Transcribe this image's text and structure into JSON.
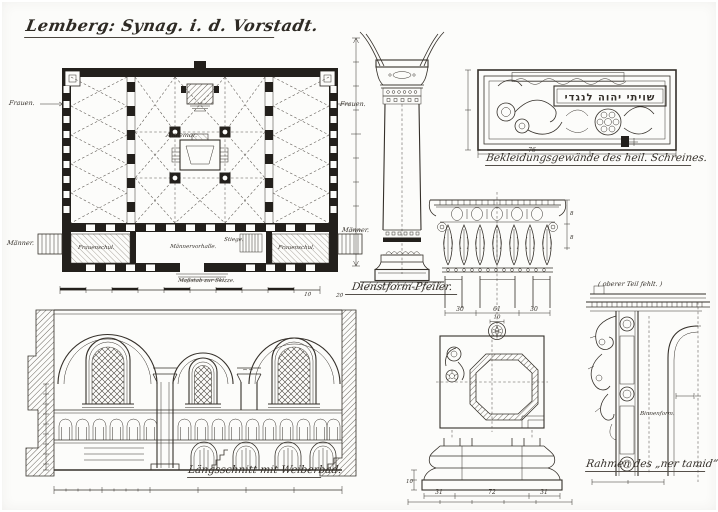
{
  "page": {
    "title": "Lemberg: Synag. i. d. Vorstadt.",
    "ink": "#35302a",
    "paper": "#fcfcfa"
  },
  "plan": {
    "labels": {
      "frauen_left": "Frauen.",
      "frauen_right": "Frauen.",
      "maenner_left": "Männer.",
      "maenner_right": "Männer.",
      "almemor": "Almemor.",
      "vorhalle": "Männervorhalle.",
      "stiege": "Stiege.",
      "frauenschul_left": "Frauenschul.",
      "frauenschul_right": "Frauenschul.",
      "scale": "Maßstab zur Skizze."
    },
    "scale_numbers": [
      "10",
      "20"
    ]
  },
  "pilaster": {
    "caption": "Dienstform-Pfeiler."
  },
  "panel": {
    "caption": "Bekleidungsgewände des heil. Schreines.",
    "hebrew_inscription": "שויתי יהוה לנגדי",
    "width_dim": "76"
  },
  "capital": {
    "dims": [
      "30",
      "61",
      "30"
    ],
    "rosette_dim": "10",
    "side_dims": [
      "8",
      "8"
    ]
  },
  "base": {
    "dims": [
      "31",
      "72",
      "31"
    ],
    "left_dim": "10"
  },
  "section": {
    "caption": "Längsschnitt mit Weiberbad."
  },
  "frame": {
    "note": "( oberer Teil fehlt. )",
    "inner_label": "Binnenform.",
    "caption": "Rahmen des „ner tamid”."
  }
}
